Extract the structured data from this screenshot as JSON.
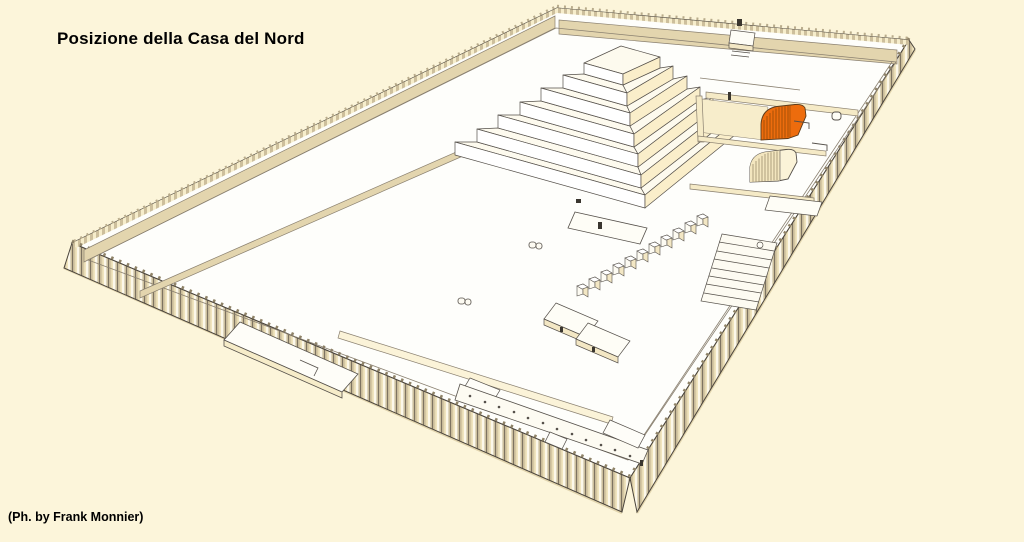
{
  "title": "Posizione della Casa del Nord",
  "attribution": "(Ph. by Frank Monnier)",
  "highlighted_building": "Casa del Nord",
  "colors": {
    "background": "#FCF5DA",
    "interior": "#FEFEFB",
    "highlight-orange": "#ED6C0D",
    "highlight-orange-dark": "#9C4E08",
    "cream-face": "#FAEECA",
    "white-face": "#FFFFFF",
    "tan-band": "#E3D5AE",
    "wall-cream": "#F5EAC6",
    "outline": "#4A443C",
    "line": "#8A8070"
  }
}
